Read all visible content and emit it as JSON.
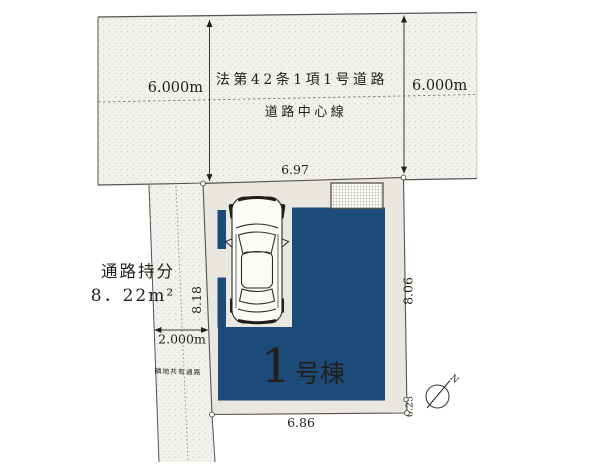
{
  "road": {
    "law_label": "法第42条1項1号道路",
    "centerline_label": "道路中心線",
    "width_left_label": "6.000m",
    "width_right_label": "6.000m"
  },
  "passage": {
    "share_title": "通路持分",
    "share_area": "8．22m²",
    "width_label": "2.000m",
    "note": "隣地共有通路"
  },
  "lot": {
    "dim_top": "6.97",
    "dim_left": "8.18",
    "dim_right": "8.06",
    "dim_bottom": "6.86",
    "dim_corner_offset": "0.25"
  },
  "building": {
    "number": "1",
    "name_suffix": "号棟"
  },
  "compass": {
    "north_label": "N"
  },
  "colors": {
    "building_navy": "#1d4b79",
    "lot_background": "#e9e7e0",
    "line": "#55534e"
  }
}
